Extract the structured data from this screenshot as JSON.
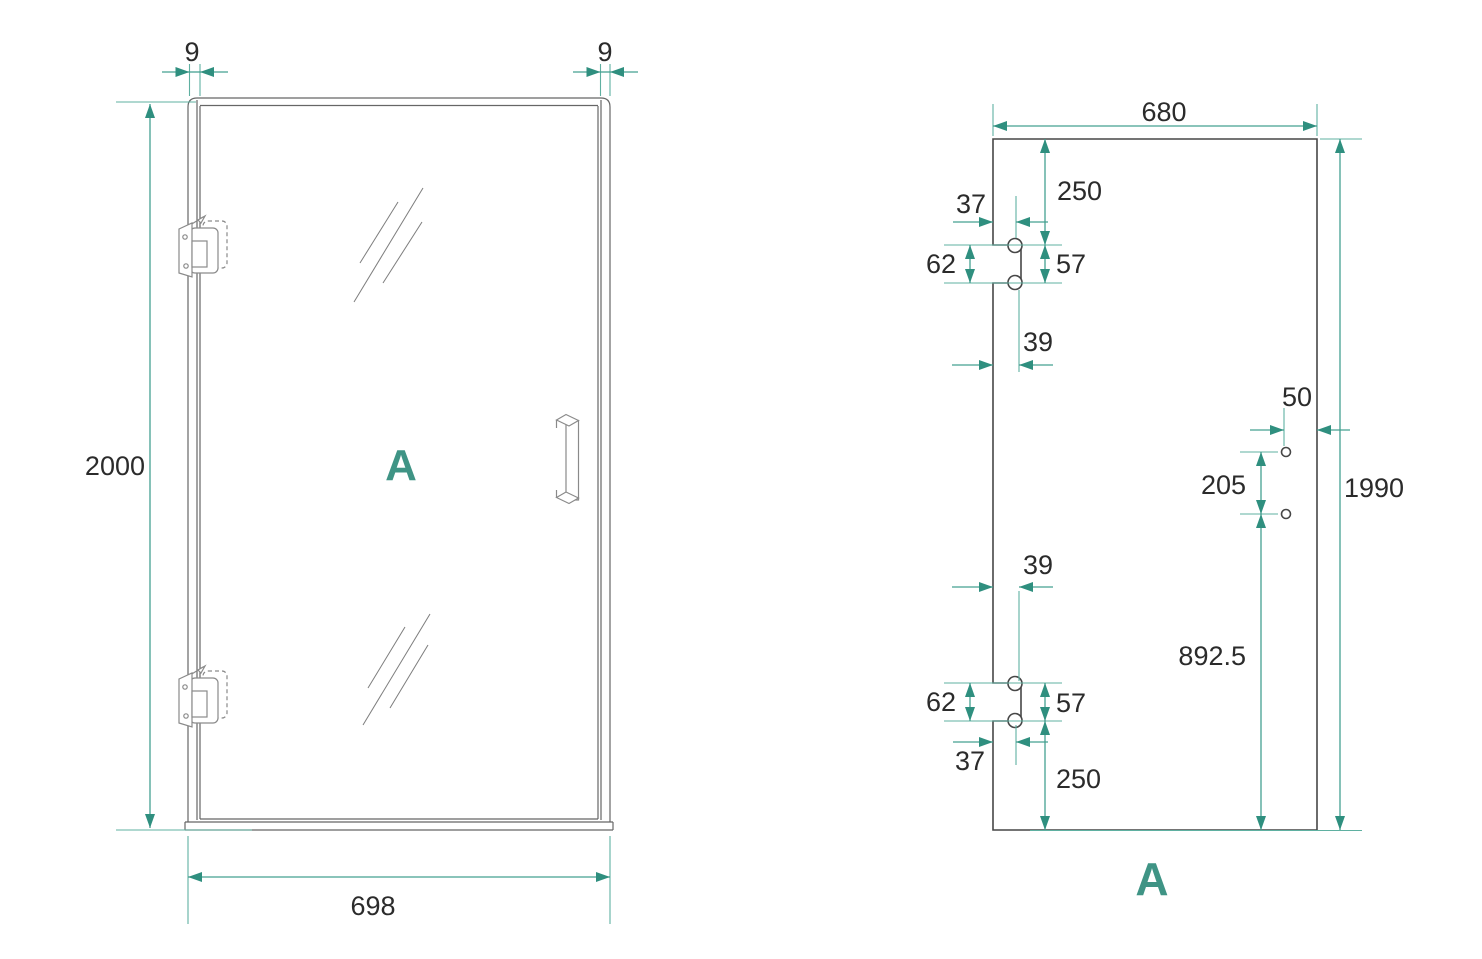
{
  "diagram": {
    "accent_color": "#3C9A89",
    "line_color": "#4A4A4A",
    "front_view": {
      "label": "A",
      "dim_profile_left": "9",
      "dim_profile_right": "9",
      "dim_height": "2000",
      "dim_width": "698"
    },
    "glass_view": {
      "label": "A",
      "dim_width": "680",
      "dim_top_offset": "250",
      "dim_top_inset": "37",
      "dim_top_cutout_height": "62",
      "dim_top_hole_spacing": "57",
      "dim_top_cutout_width": "39",
      "dim_handle_hole_edge": "50",
      "dim_handle_hole_spacing": "205",
      "dim_height": "1990",
      "dim_bottom_cutout_width": "39",
      "dim_handle_to_bottom": "892.5",
      "dim_bottom_cutout_height": "62",
      "dim_bottom_hole_spacing": "57",
      "dim_bottom_inset": "37",
      "dim_bottom_offset": "250"
    }
  }
}
